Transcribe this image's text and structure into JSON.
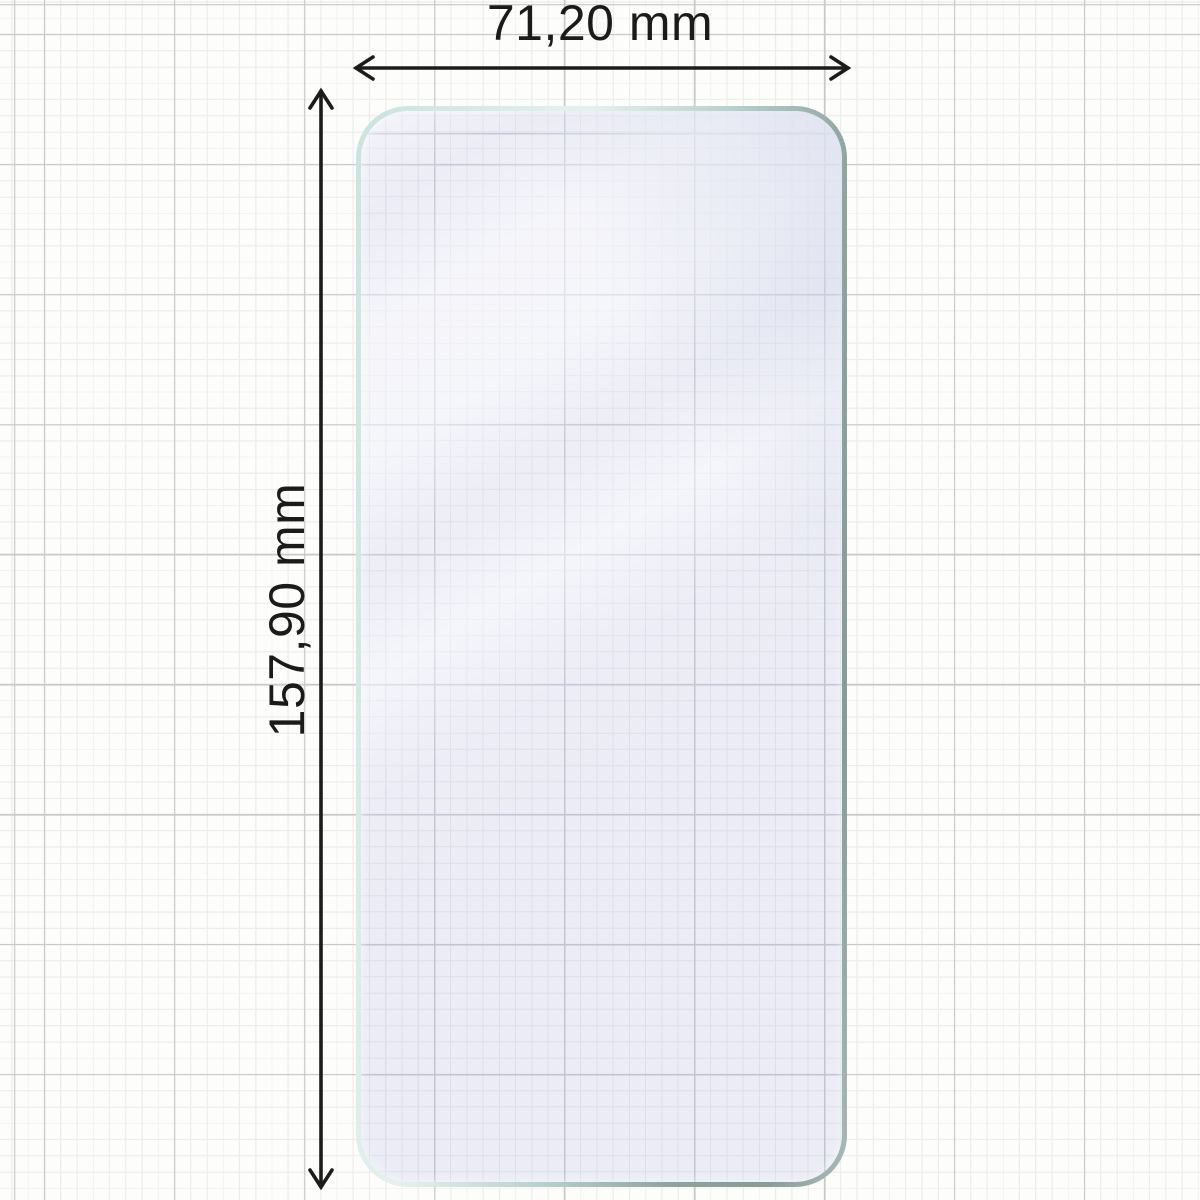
{
  "diagram": {
    "width_label": "71,20 mm",
    "height_label": "157,90 mm"
  },
  "colors": {
    "paper_background": "#fdfdfc",
    "grid_minor": "#ecece9",
    "grid_major": "#c9c9c8",
    "glass_edge_light_teal": "#cbe3df",
    "glass_edge_dark_gray_green": "#879b97",
    "glass_fill_lavender": "#ebecf5",
    "glass_grid_minor": "#dcdeea",
    "glass_grid_major": "#c2c4d3",
    "dimension_line": "#1c1c1c",
    "label_text": "#1b1b1b"
  }
}
